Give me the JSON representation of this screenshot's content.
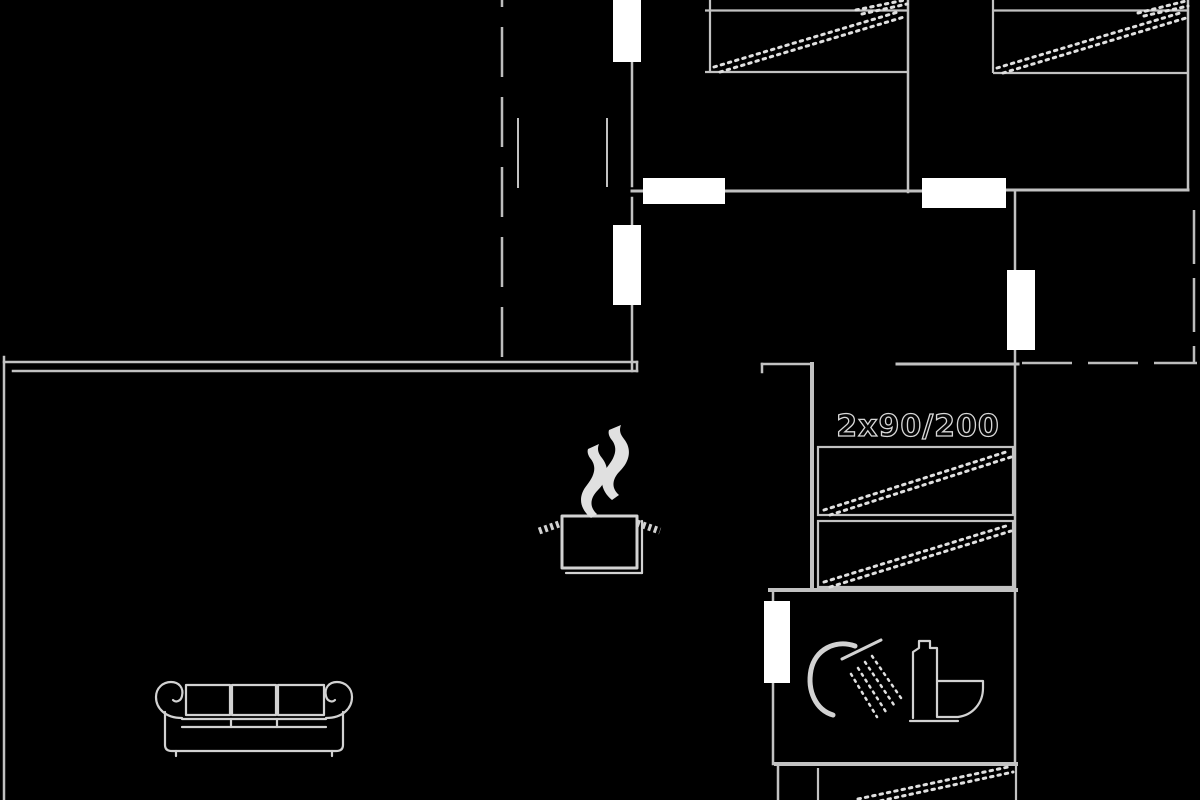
{
  "page": {
    "type": "floor-plan",
    "background": "#000000"
  },
  "labels": {
    "bed_size": "2x90/200"
  },
  "colors": {
    "background": "#000000",
    "wall": "#c2c2c2",
    "dashed": "#bdbdbd",
    "marker_fill": "#ffffff",
    "dots": "#e0e0e0",
    "icon": "#d2d2d2",
    "label_fill": "#050505",
    "label_stroke": "#d8d8d8"
  },
  "icons": {
    "kitchen": "steaming-pot-icon",
    "living_room": "sofa-icon",
    "bathroom": [
      "shower-icon",
      "toilet-icon"
    ],
    "beds": [
      "bed-top-left-icon",
      "bed-top-right-icon",
      "bed-middle-1-icon",
      "bed-middle-2-icon",
      "bed-bottom-icon"
    ]
  }
}
